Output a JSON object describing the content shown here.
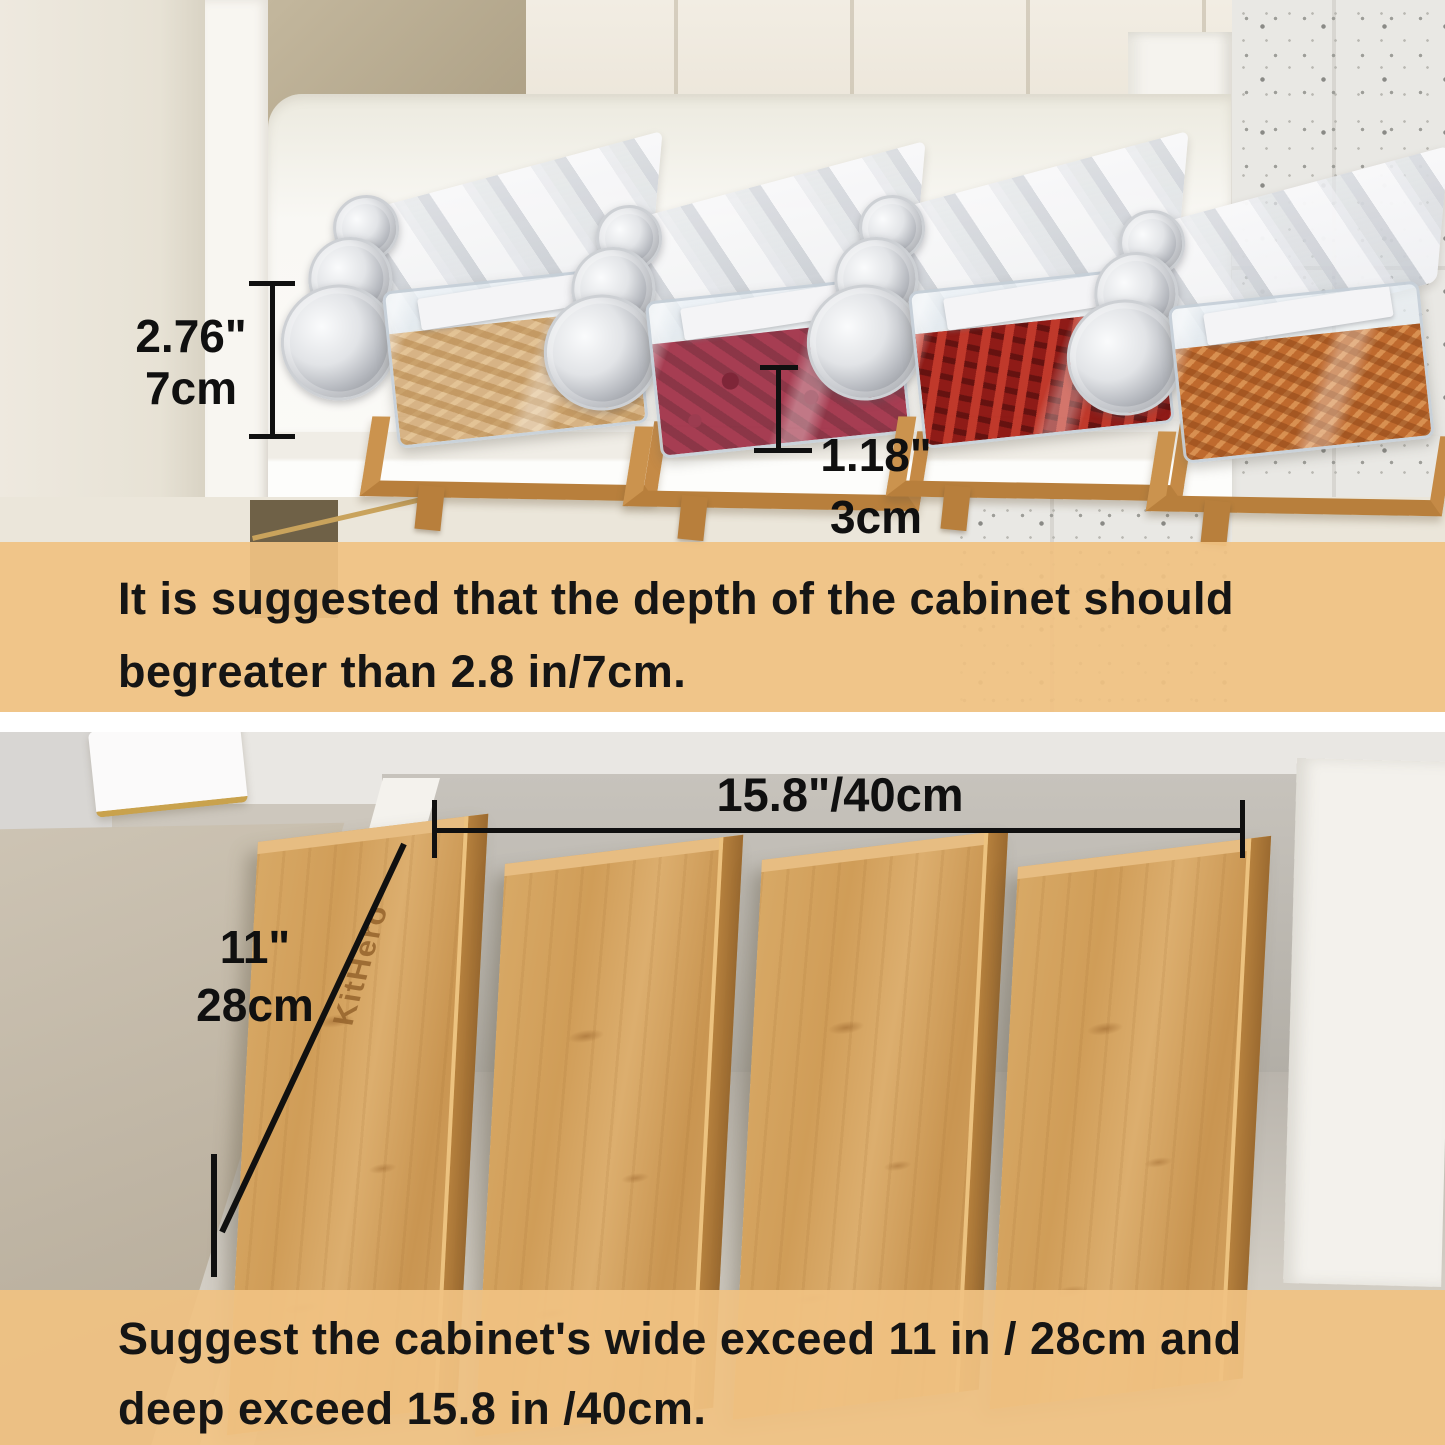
{
  "page": {
    "type": "product-dimension-infographic"
  },
  "top_section": {
    "height_dim": {
      "inches": "2.76\"",
      "cm": "7cm"
    },
    "riser_dim": {
      "inches": "1.18\"",
      "cm": "3cm"
    },
    "note_line1": "It is suggested that the depth of the cabinet should",
    "note_line2": "begreater than 2.8 in/7cm."
  },
  "bottom_section": {
    "depth_dim": "15.8\"/40cm",
    "width_dim": {
      "inches": "11\"",
      "cm": "28cm"
    },
    "brand": "KitHero",
    "note_line1": "Suggest the cabinet's wide exceed 11 in / 28cm and",
    "note_line2": "deep exceed 15.8 in /40cm."
  },
  "colors": {
    "banner": "#F0C282",
    "bamboo": "#CE9A57",
    "annotation_text": "#101010"
  }
}
